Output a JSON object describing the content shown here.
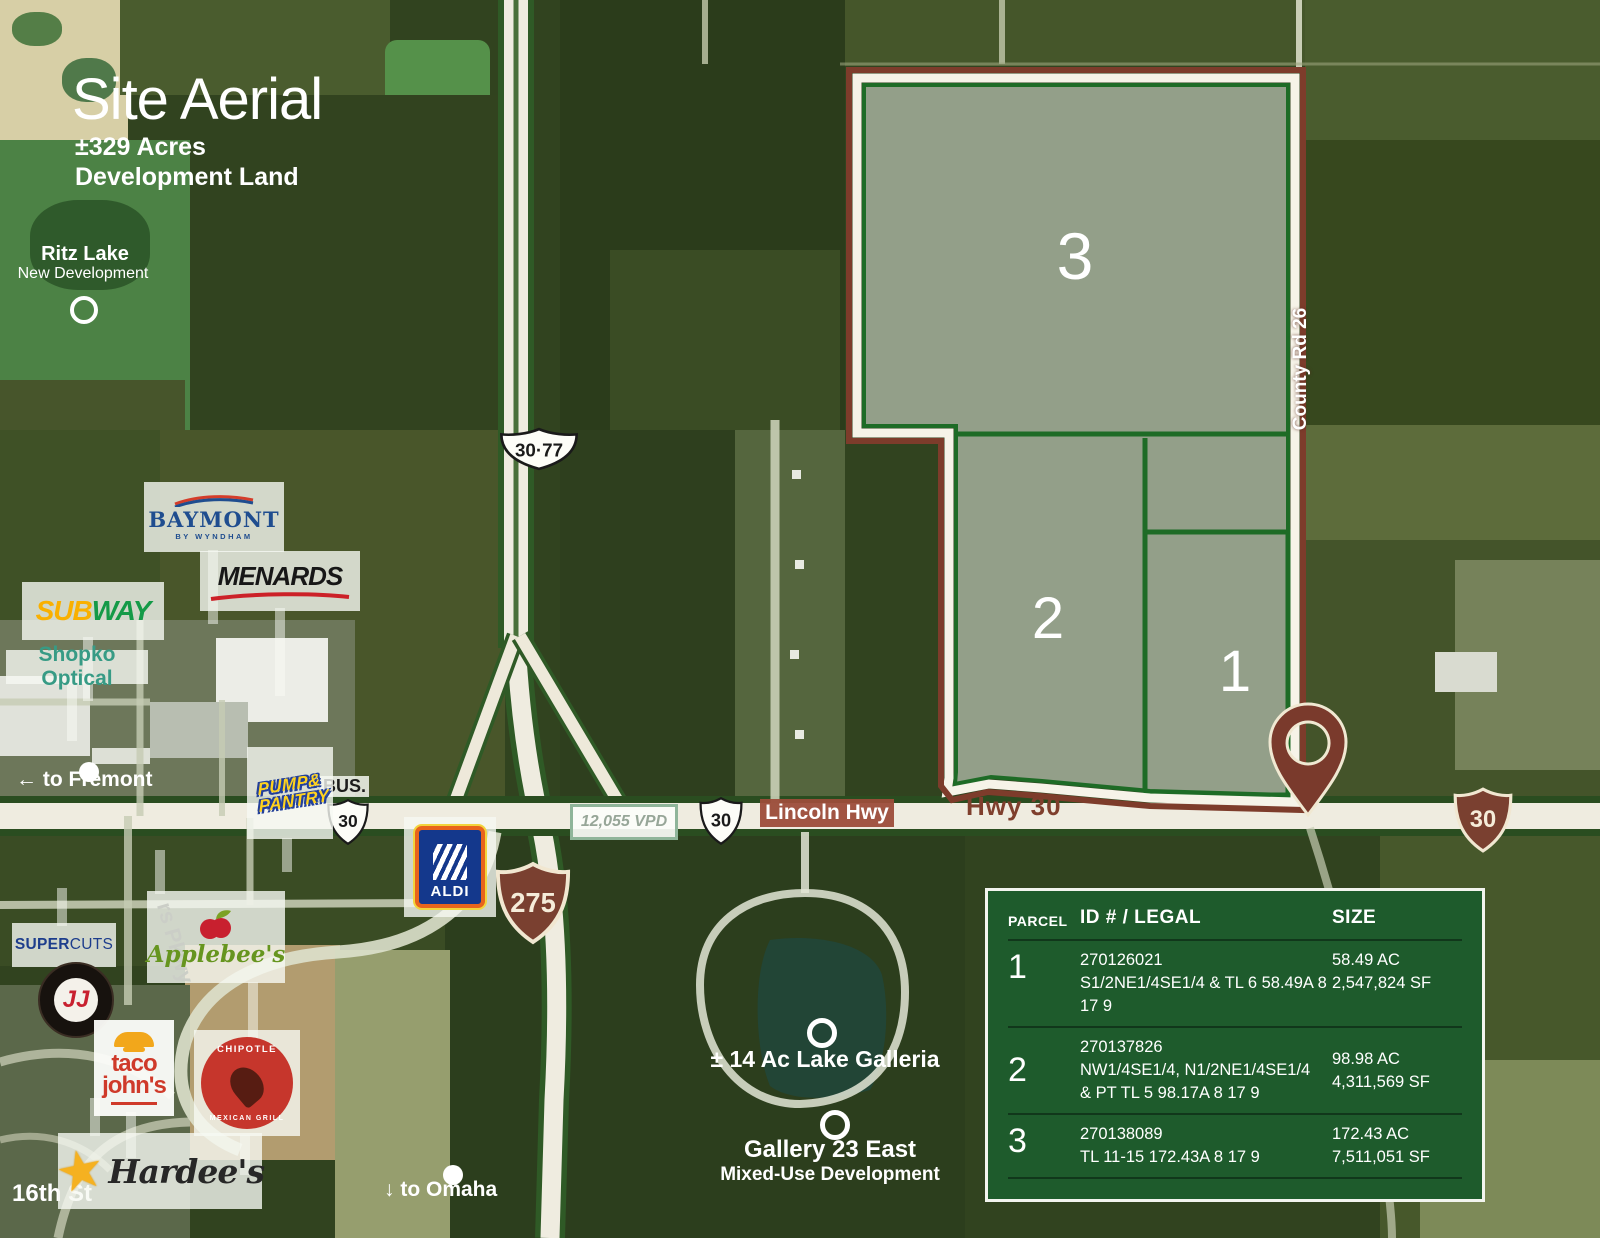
{
  "title": {
    "heading": "Site Aerial",
    "acres": "±329 Acres",
    "land": "Development Land"
  },
  "labels": {
    "ritz_lake": "Ritz Lake",
    "ritz_sub": "New Development",
    "fremont_arrow": "←",
    "to_fremont": "to Fremont",
    "omaha_arrow": "↓",
    "to_omaha": "to Omaha",
    "sixteenth_st": "16th St",
    "pkwy": "rs Pkwy",
    "county_rd": "County Rd 26",
    "lincoln_hwy": "Lincoln Hwy",
    "hwy_30": "Hwy 30",
    "vpd": "12,055 VPD",
    "lake_galleria": "± 14 Ac Lake Galleria",
    "gallery_23": "Gallery 23 East",
    "gallery_23_sub": "Mixed-Use Development"
  },
  "shields": {
    "us30_77": "30·77",
    "bus": "BUS.",
    "s30": "30",
    "s275": "275"
  },
  "parcels": {
    "p1": "1",
    "p2": "2",
    "p3": "3"
  },
  "logos": {
    "baymont": "BAYMONT",
    "baymont_sub": "BY WYNDHAM",
    "menards": "MENARDS",
    "subway_a": "SUB",
    "subway_b": "WAY",
    "shopko": "Shopko Optical",
    "pump_1": "PUMP&",
    "pump_2": "PANTRY",
    "aldi": "ALDI",
    "supercuts_a": "SUPER",
    "supercuts_b": "CUTS",
    "jj": "JJ",
    "applebees": "Applebee's",
    "taco_1": "taco",
    "taco_2": "john's",
    "chipotle_top": "CHIPOTLE",
    "chipotle_bottom": "MEXICAN GRILL",
    "hardees": "Hardee's"
  },
  "table": {
    "headers": {
      "parcel": "PARCEL",
      "id_legal": "ID # / LEGAL",
      "size": "SIZE"
    },
    "rows": [
      {
        "num": "1",
        "id": [
          "270126021",
          "S1/2NE1/4SE1/4 & TL 6 58.49A 8 17 9"
        ],
        "size": [
          "58.49 AC",
          "2,547,824 SF"
        ]
      },
      {
        "num": "2",
        "id": [
          "270137826",
          "NW1/4SE1/4, N1/2NE1/4SE1/4",
          "& PT TL 5 98.17A 8 17 9"
        ],
        "size": [
          "98.98 AC",
          "4,311,569 SF"
        ]
      },
      {
        "num": "3",
        "id": [
          "270138089",
          "TL 11-15 172.43A 8 17 9"
        ],
        "size": [
          "172.43 AC",
          "7,511,051 SF"
        ]
      }
    ]
  },
  "colors": {
    "boundary": "#7d3c2b",
    "parcel_line": "#1e6b26",
    "table_bg": "#1e5b2c",
    "shield_brown": "#7a4030"
  }
}
